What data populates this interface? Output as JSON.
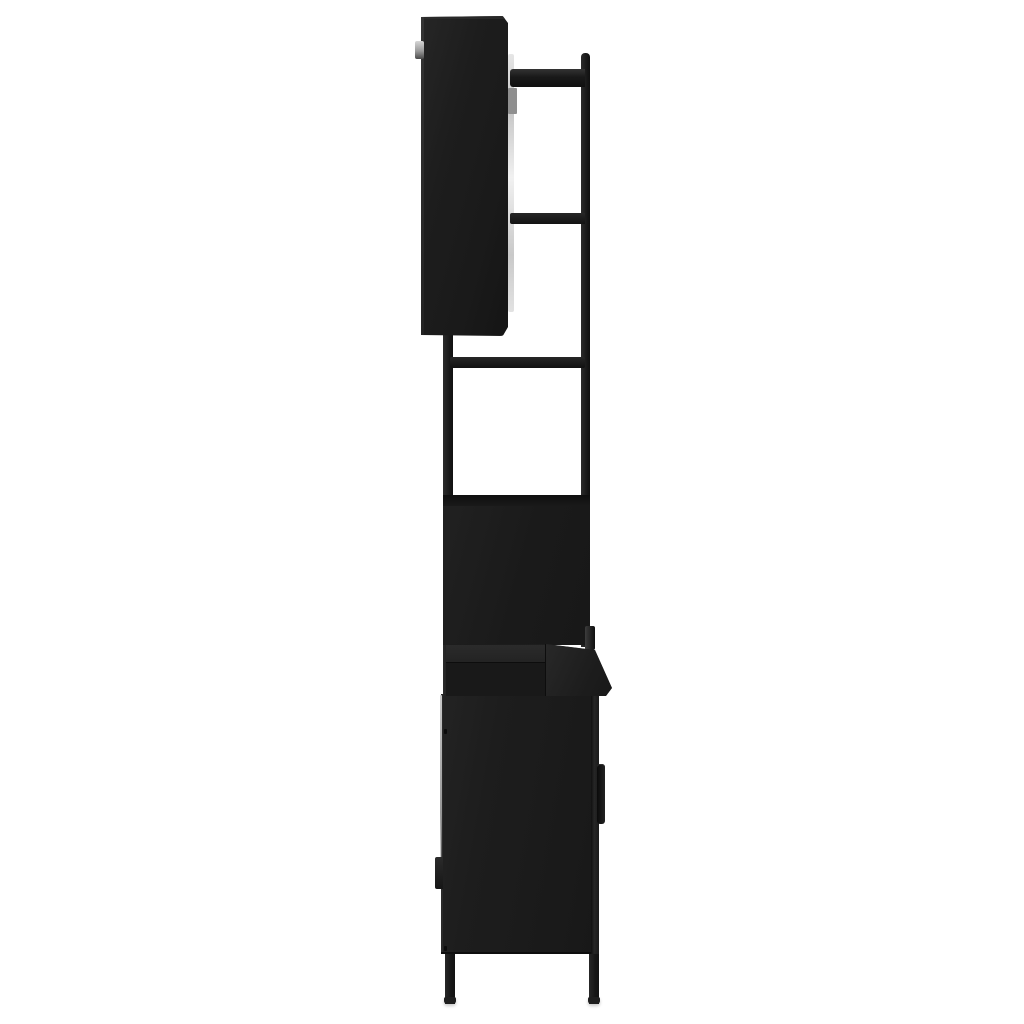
{
  "scene": {
    "alt": "Side profile product photo of a black bathroom furniture set on a white background: a wall-mounted mirror cabinet at top with a small hinge tab and visible light mirror edge, a vertical frame pole with three shelf cross-bars, an open compartment back panel, a countertop slab, and a base cabinet with a side door handle, hinge fittings and four slim legs."
  },
  "colors": {
    "background": "#ffffff",
    "furniture-base": "#1a1a1a",
    "furniture-dark": "#101010",
    "furniture-highlight": "#2e2e2e",
    "mirror-edge": "#e6e6e6",
    "metal-gray": "#8f8f8f",
    "pale-edge": "#c9c9c9",
    "shadow": "rgba(0,0,0,0.22)"
  }
}
